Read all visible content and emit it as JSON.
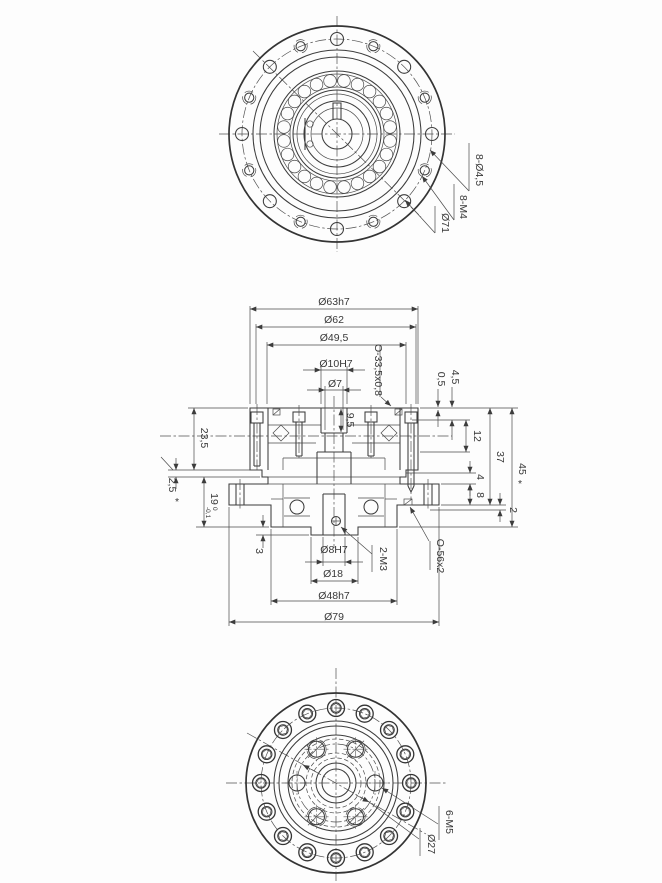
{
  "drawing": {
    "front_view": {
      "label_through_holes": "8-Ø4,5",
      "label_tapped_holes": "8-M4",
      "label_bolt_circle": "Ø71"
    },
    "section_view": {
      "dia_outer": "Ø63h7",
      "dia_62": "Ø62",
      "dia_49_5": "Ø49,5",
      "dia_10": "Ø10H7",
      "dia_7": "Ø7",
      "oring_top": "O-33,5x0,8",
      "dim_0_5": "0,5",
      "dim_4_5": "4,5",
      "dim_12": "12",
      "dim_37": "37",
      "dim_45": "45",
      "footnote_star": "*",
      "dim_9_5": "9,5",
      "dim_23_5": "23,5",
      "dim_2_5": "2,5",
      "dim_19": "19",
      "tol_upper": "0",
      "tol_lower": "-0,1",
      "dim_4": "4",
      "dim_8": "8",
      "dim_2": "2",
      "dim_3": "3",
      "dia_8": "Ø8H7",
      "dia_18": "Ø18",
      "dia_48": "Ø48h7",
      "dia_79": "Ø79",
      "label_set_screws": "2-M3",
      "oring_bottom": "O-56x2"
    },
    "back_view": {
      "label_tapped_holes": "6-M5",
      "label_bolt_circle": "Ø27"
    }
  }
}
